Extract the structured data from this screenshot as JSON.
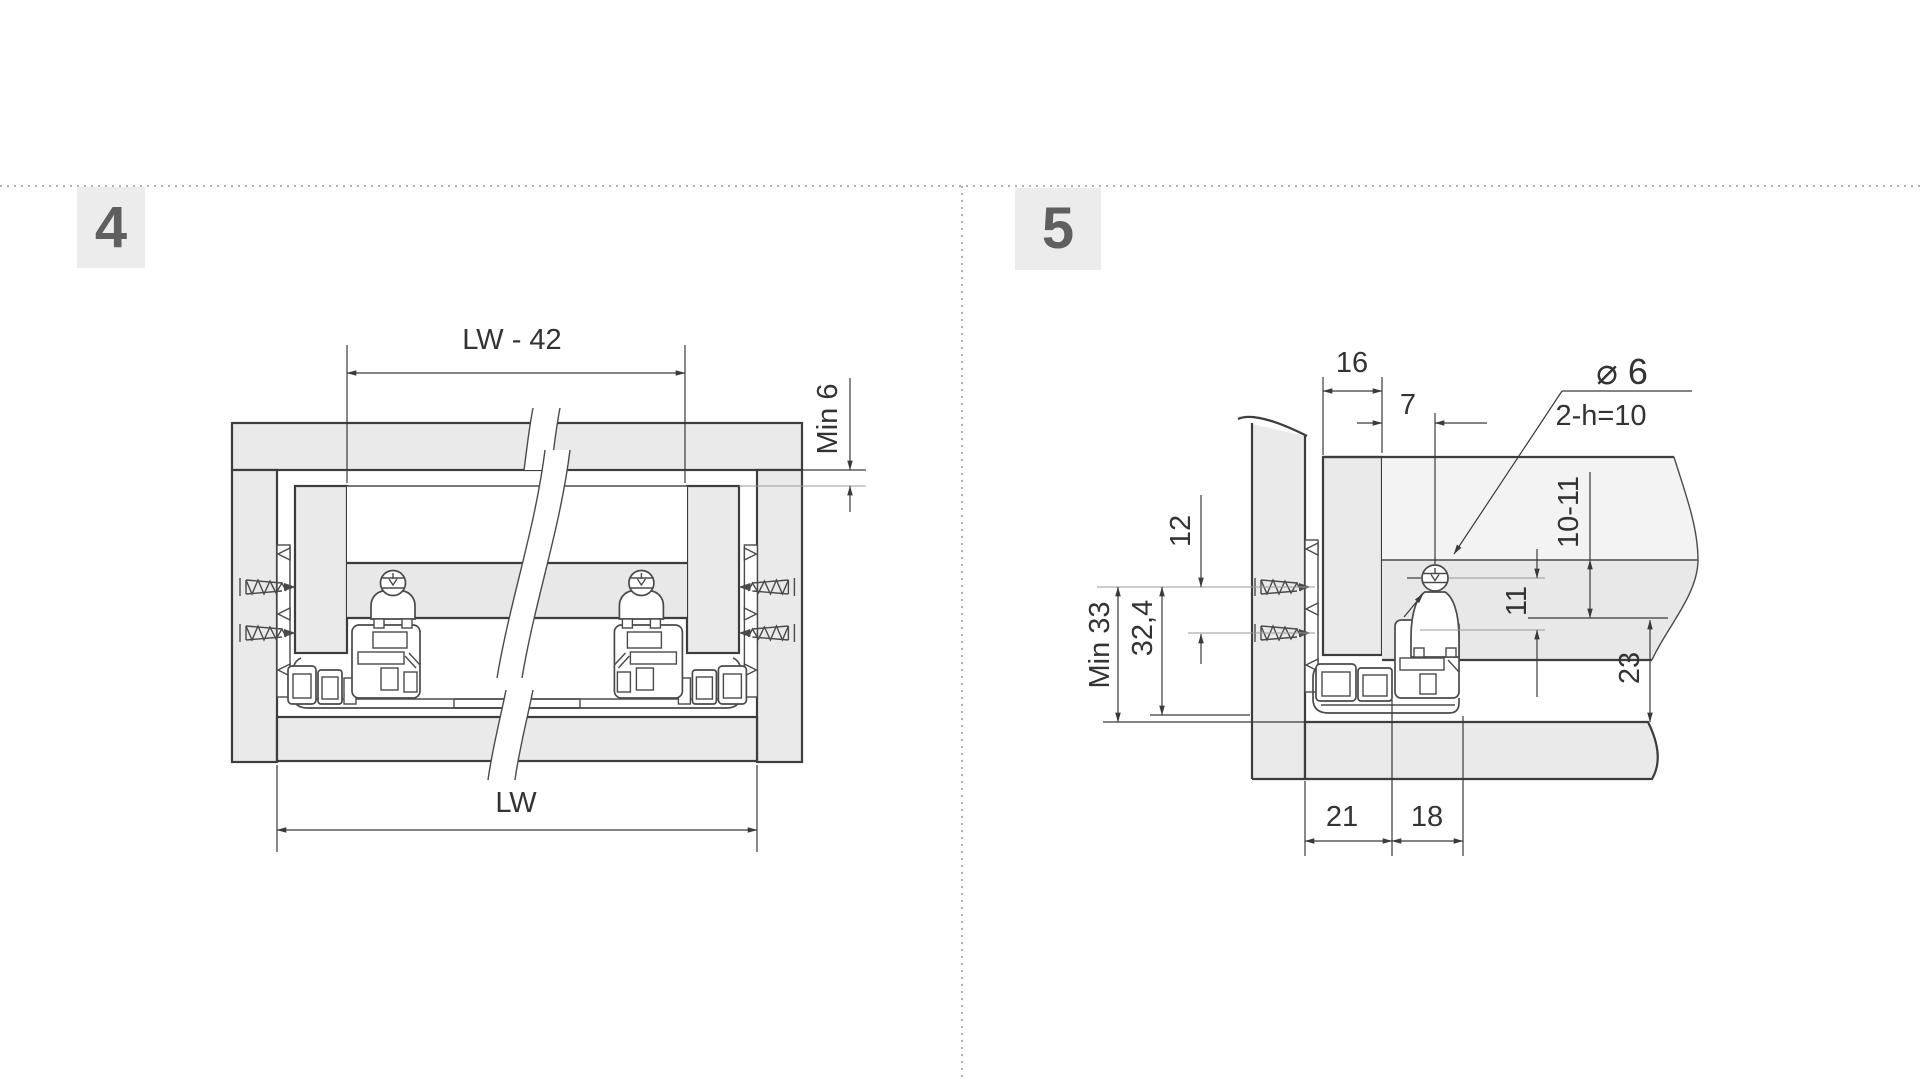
{
  "step4": {
    "badge": "4",
    "dim_width_top": "LW - 42",
    "dim_min_gap": "Min 6",
    "dim_width_bottom": "LW"
  },
  "step5": {
    "badge": "5",
    "dim_side_thickness": "16",
    "dim_cam_offset": "7",
    "dim_hole_diameter": "⌀ 6",
    "dim_hole_note": "2-h=10",
    "dim_screw_spacing": "12",
    "dim_min_height": "Min 33",
    "dim_screw_height": "32,4",
    "dim_bottom_recess": "10-11",
    "dim_cam_drop": "11",
    "dim_clearance": "23",
    "dim_front_offset": "21",
    "dim_cam_pitch": "18"
  },
  "colors": {
    "line": "#3d3d3d",
    "panel_fill": "#eaeaea",
    "band_fill": "#e8e8e8",
    "light_fill": "#f3f3f3",
    "dim_text": "#333333",
    "badge_bg": "#ececec",
    "badge_text": "#5f5f5f",
    "dotted_separator": "#b0b0b0"
  }
}
